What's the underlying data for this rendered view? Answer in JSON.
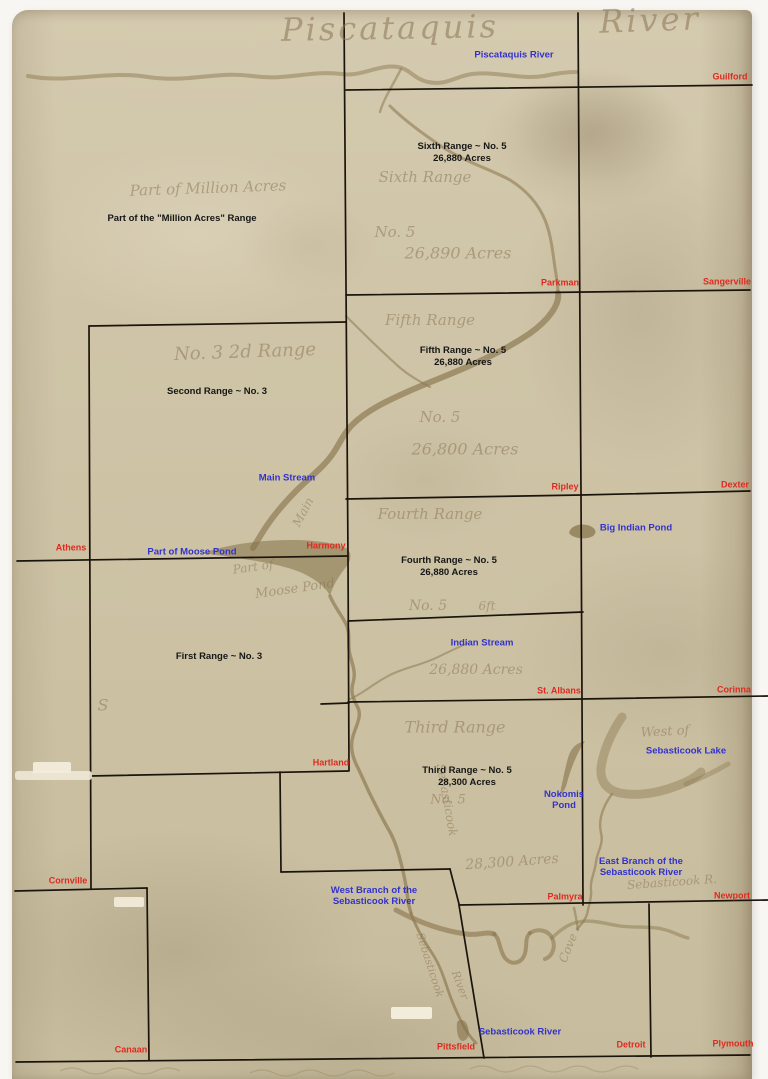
{
  "map": {
    "title_script": {
      "part1": "Piscataquis",
      "part2": "River"
    },
    "colors": {
      "paper": "#cfc4a8",
      "boundary_line": "#1b140c",
      "water_label": "#3232cc",
      "town_label": "#e02a1f",
      "range_label": "#161616",
      "river": "#8d7a52",
      "handwriting": "#8a7452",
      "background": "#f7f6f2"
    },
    "ranges": [
      {
        "name": "Part of the \"Million Acres\" Range",
        "acres": ""
      },
      {
        "name": "Sixth Range ~ No. 5",
        "acres": "26,880 Acres"
      },
      {
        "name": "Fifth Range ~ No. 5",
        "acres": "26,880 Acres"
      },
      {
        "name": "Second Range ~ No. 3",
        "acres": ""
      },
      {
        "name": "Fourth Range ~ No. 5",
        "acres": "26,880 Acres"
      },
      {
        "name": "First Range ~ No. 3",
        "acres": ""
      },
      {
        "name": "Third Range ~ No. 5",
        "acres": "28,300 Acres"
      }
    ],
    "towns": [
      {
        "label": "Guilford"
      },
      {
        "label": "Parkman"
      },
      {
        "label": "Sangerville"
      },
      {
        "label": "Ripley"
      },
      {
        "label": "Dexter"
      },
      {
        "label": "Athens"
      },
      {
        "label": "Harmony"
      },
      {
        "label": "St. Albans"
      },
      {
        "label": "Corinna"
      },
      {
        "label": "Hartland"
      },
      {
        "label": "Cornville"
      },
      {
        "label": "Palmyra"
      },
      {
        "label": "Newport"
      },
      {
        "label": "Canaan"
      },
      {
        "label": "Pittsfield"
      },
      {
        "label": "Detroit"
      },
      {
        "label": "Plymouth"
      }
    ],
    "waters": [
      {
        "label": "Piscataquis River"
      },
      {
        "label": "Main Stream"
      },
      {
        "label": "Part of Moose Pond"
      },
      {
        "label": "Big Indian Pond"
      },
      {
        "label": "Indian Stream"
      },
      {
        "label": "Sebasticook Lake"
      },
      {
        "label": "Nokomis Pond"
      },
      {
        "label": "East Branch of the Sebasticook River"
      },
      {
        "label": "West Branch of the Sebasticook River"
      },
      {
        "label": "Sebasticook River"
      }
    ],
    "script": [
      "Piscataquis",
      "River",
      "Part of Million Acres",
      "Sixth Range",
      "No. 5",
      "26,890 Acres",
      "No. 3  2d Range",
      "Fifth Range",
      "No. 5",
      "26,800 Acres",
      "Fourth Range",
      "No. 5",
      "6ft",
      "26,880 Acres",
      "Part of",
      "Moose Pond",
      "Main",
      "Third Range",
      "No. 5",
      "28,300 Acres",
      "West of",
      "Sebasticook R.",
      "Cove",
      "S",
      "Sebasticook",
      "Sebasticook",
      "River"
    ]
  }
}
